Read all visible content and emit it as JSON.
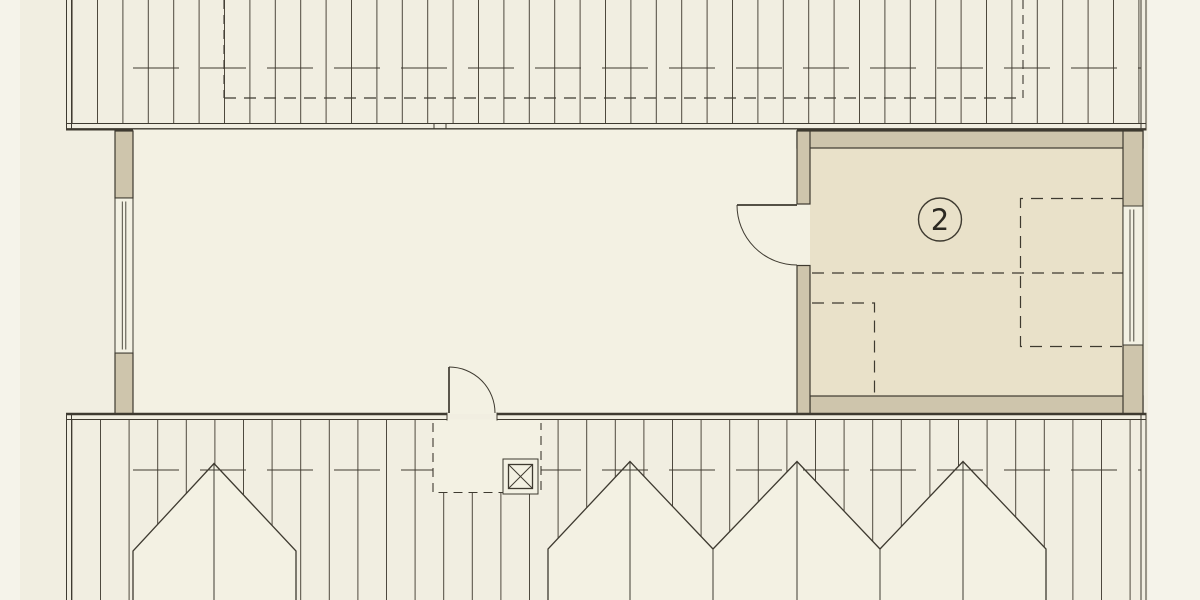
{
  "drawing": {
    "room_labels": [
      {
        "id": "room-2",
        "label": "2"
      }
    ]
  },
  "palette": {
    "page_bg": "#f1eee1",
    "margin_light": "#f5f3ea",
    "floor_main": "#f3f1e3",
    "floor_room2": "#e9e1c9",
    "wall_fill": "#cec5ac",
    "line": "#3e3a30"
  }
}
